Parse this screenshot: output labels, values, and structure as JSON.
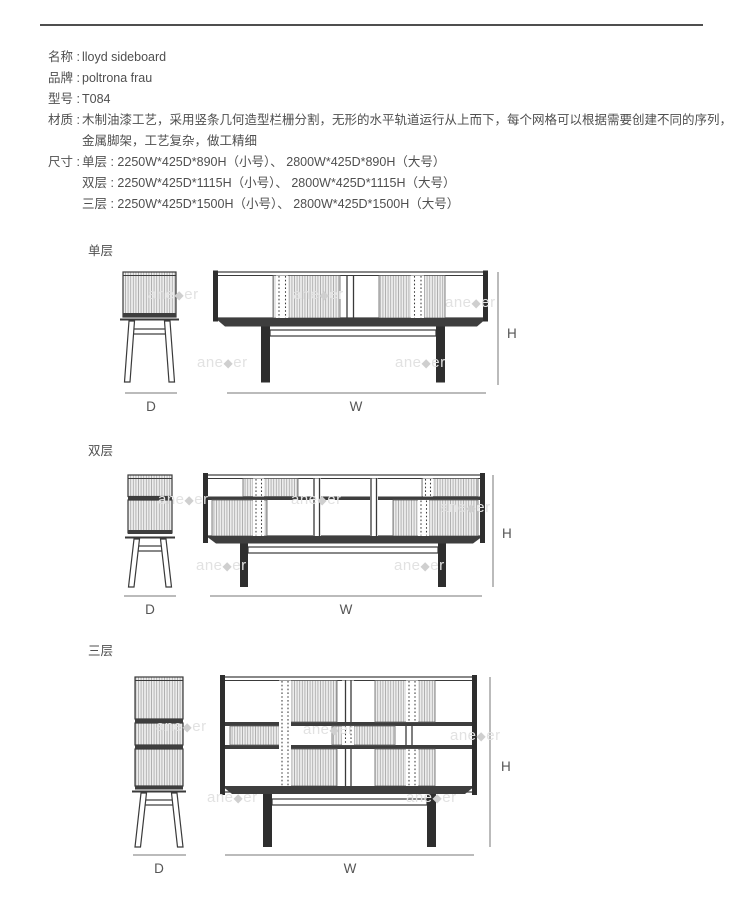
{
  "page_title": "lloyd sideboard 规格图",
  "specs": {
    "name": {
      "label": "名称 :",
      "value": "lloyd sideboard"
    },
    "brand": {
      "label": "品牌 :",
      "value": "poltrona frau"
    },
    "model": {
      "label": "型号 :",
      "value": "T084"
    },
    "material": {
      "label": "材质 :",
      "value_line1": "木制油漆工艺，采用竖条几何造型栏栅分割，无形的水平轨道运行从上而下，每个网格可以根据需要创建不同的序列，",
      "value_line2": "金属脚架，工艺复杂，做工精细"
    },
    "size": {
      "label": "尺寸 :",
      "line1": "单层 : 2250W*425D*890H（小号）、 2800W*425D*890H（大号）",
      "line2": "双层 : 2250W*425D*1115H（小号）、 2800W*425D*1115H（大号）",
      "line3": "三层 : 2250W*425D*1500H（小号）、 2800W*425D*1500H（大号）"
    }
  },
  "figures": {
    "single": {
      "title": "单层",
      "d_label": "D",
      "w_label": "W",
      "h_label": "H"
    },
    "double": {
      "title": "双层",
      "d_label": "D",
      "w_label": "W",
      "h_label": "H"
    },
    "triple": {
      "title": "三层",
      "d_label": "D",
      "w_label": "W",
      "h_label": "H"
    }
  },
  "colors": {
    "text": "#4f4f4f",
    "rule": "#4f4f4f",
    "line_art": "#3a3a3a",
    "dark_band": "#3e3e3e",
    "dim_line": "#777777"
  },
  "watermark": {
    "text_prefix": "ane",
    "text_diamond": "◆",
    "text_suffix": "er",
    "color": "#e2e2e2",
    "diamond_color": "#cfcfcf",
    "positions": [
      [
        148,
        287
      ],
      [
        293,
        287
      ],
      [
        445,
        295
      ],
      [
        197,
        355
      ],
      [
        395,
        355
      ],
      [
        158,
        492
      ],
      [
        291,
        492
      ],
      [
        440,
        500
      ],
      [
        196,
        558
      ],
      [
        394,
        558
      ],
      [
        156,
        719
      ],
      [
        303,
        722
      ],
      [
        450,
        728
      ],
      [
        207,
        790
      ],
      [
        406,
        790
      ]
    ]
  }
}
